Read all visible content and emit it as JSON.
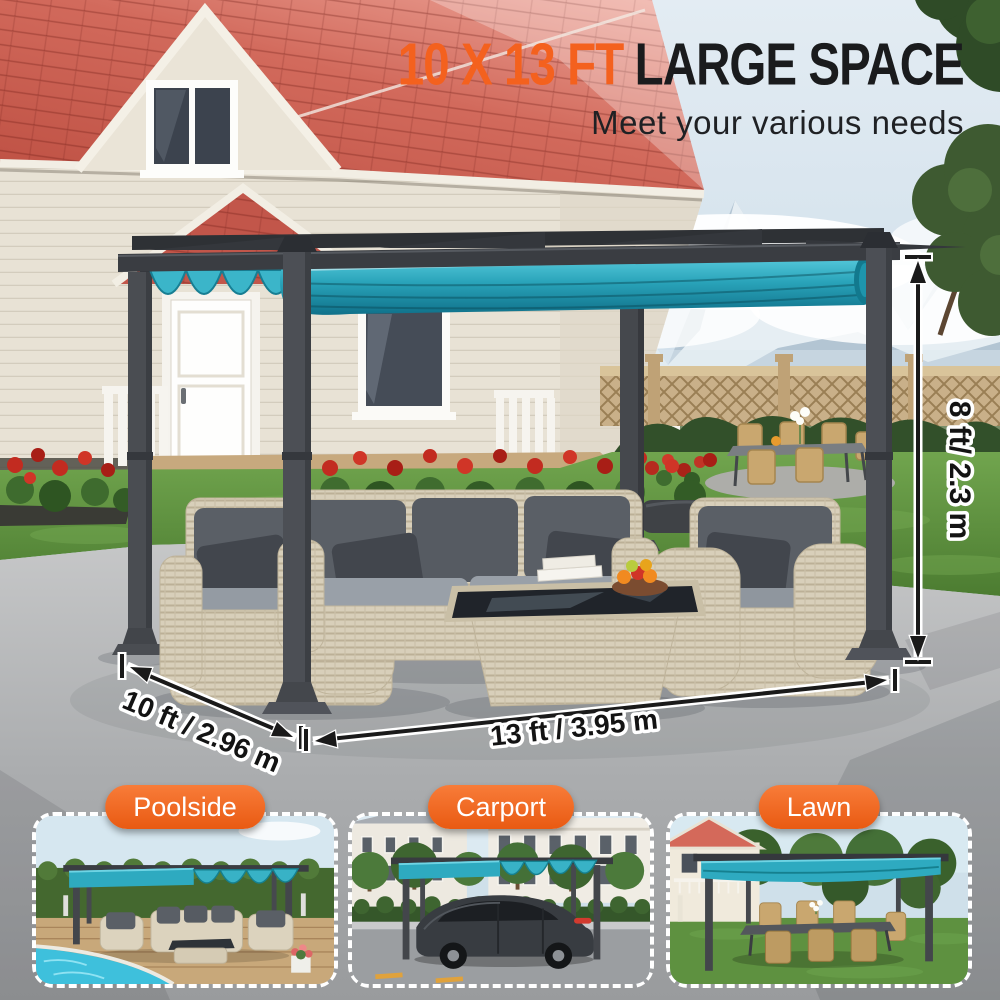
{
  "header": {
    "title_accent": "10 X 13 FT",
    "title_rest": "LARGE SPACE",
    "subtitle": "Meet your various needs"
  },
  "dimensions": {
    "height": "8 ft/ 2.3 m",
    "side": "10 ft / 2.96 m",
    "front": "13 ft / 3.95 m"
  },
  "thumbnails": [
    {
      "label": "Poolside"
    },
    {
      "label": "Carport"
    },
    {
      "label": "Lawn"
    }
  ],
  "colors": {
    "accent_orange": "#F4611E",
    "title_dark": "#1A1B1D",
    "canopy_teal": "#2BA6BD",
    "frame_gray": "#45484D",
    "roof_red": "#C9604F",
    "label_text_white": "#FFFFFF"
  }
}
